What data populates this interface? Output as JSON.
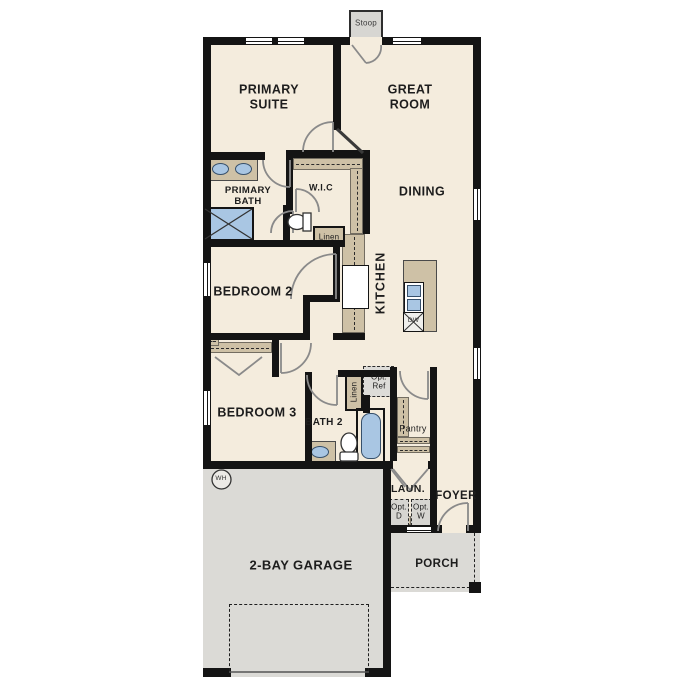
{
  "plan_title": "single-story floor plan",
  "colors": {
    "floor": "#f4ecdd",
    "wall": "#141414",
    "tan": "#cec1a6",
    "blue": "#a9c6e3",
    "gray": "#dbdad6",
    "doorline": "#8a8a8a"
  },
  "rooms": {
    "primary_suite": "PRIMARY SUITE",
    "great_room": "GREAT ROOM",
    "primary_bath": "PRIMARY BATH",
    "wic": "W.I.C",
    "dining": "DINING",
    "kitchen": "KITCHEN",
    "bedroom2": "BEDROOM 2",
    "bedroom3": "BEDROOM 3",
    "bath2": "BATH 2",
    "laundry": "LAUN.",
    "foyer": "FOYER",
    "porch": "PORCH",
    "garage": "2-BAY GARAGE"
  },
  "features": {
    "stoop": "Stoop",
    "linen_kitchen": "Linen",
    "linen_bath": "Linen",
    "opt_ref": "Opt. Ref",
    "pantry": "Pantry",
    "opt_dryer": "Opt. D",
    "opt_washer": "Opt. W",
    "dishwasher": "DW",
    "water_heater": "WH"
  }
}
